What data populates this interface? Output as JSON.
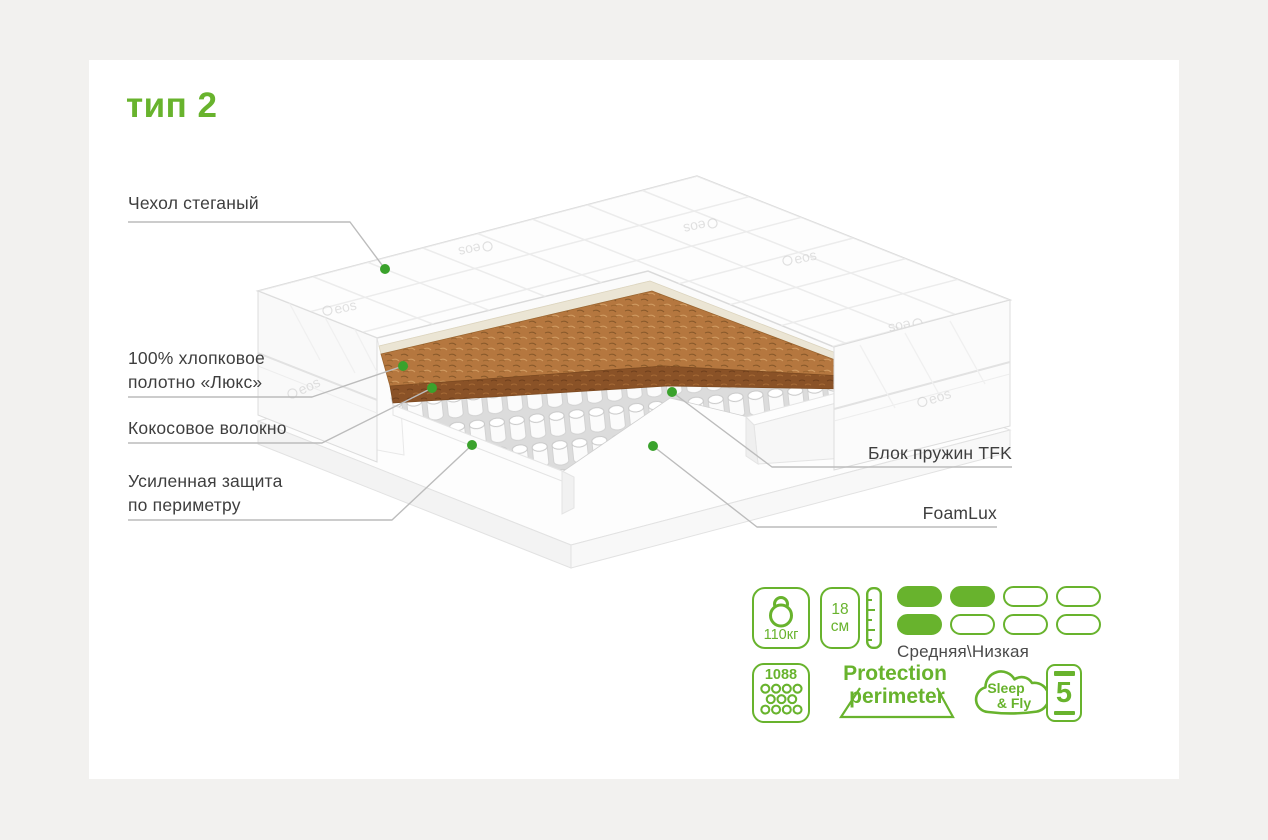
{
  "title": "тип 2",
  "colors": {
    "accent": "#68b32d",
    "dot": "#3aa22c",
    "leader_line": "#bcbcbc",
    "label_text": "#3e3e3e",
    "background": "#f2f1ef",
    "content_background": "#ffffff",
    "coconut": "#b5773f",
    "coconut_dark": "#8a5227"
  },
  "cover_brand": "eos",
  "callouts": {
    "left": [
      {
        "text": "Чехол стеганый"
      },
      {
        "text": "100% хлопковое\nполотно «Люкс»"
      },
      {
        "text": "Кокосовое волокно"
      },
      {
        "text": "Усиленная защита\nпо периметру"
      }
    ],
    "right": [
      {
        "text": "Блок пружин TFK"
      },
      {
        "text": "FoamLux"
      }
    ]
  },
  "badges": {
    "weight": "110кг",
    "height_value": "18",
    "height_unit": "см",
    "firmness_label": "Средняя\\Низкая",
    "firmness_rows": [
      [
        1,
        1,
        0,
        0
      ],
      [
        1,
        0,
        0,
        0
      ]
    ],
    "springs_count": "1088",
    "protection_line1": "Protection",
    "protection_line2": "perimeter",
    "brand_line1": "Sleep",
    "brand_line2": "& Fly",
    "warranty_years": "5"
  }
}
